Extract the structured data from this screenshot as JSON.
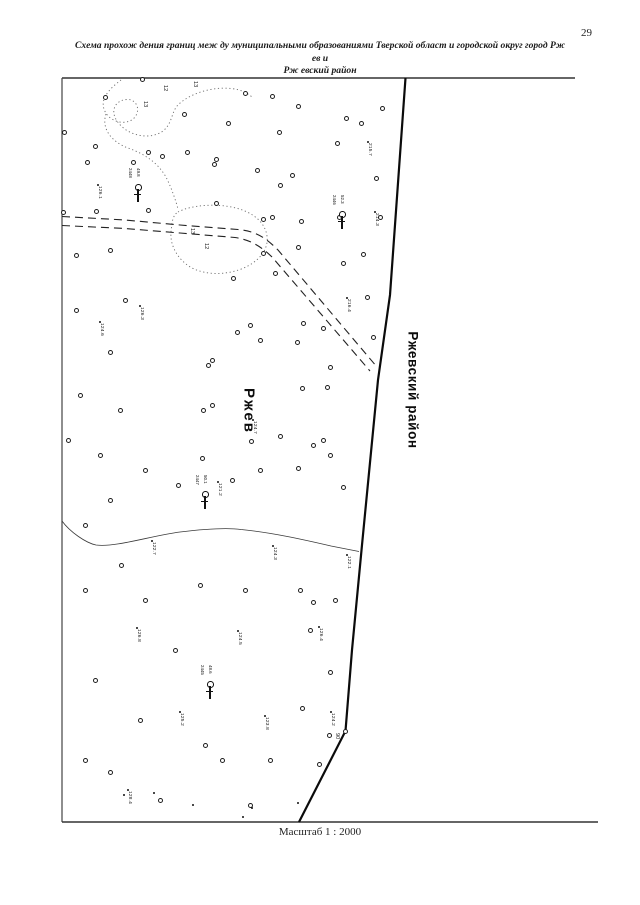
{
  "page": {
    "number": "29",
    "title_line1": "Схема прохож дения границ меж ду муниципальными образованиями Тверской област и городской округ город Рж ев и",
    "title_line2": "Рж евский район",
    "scale_label": "Масштаб 1 : 2000"
  },
  "map": {
    "labels": {
      "city": "Ржев",
      "district": "Ржевский район"
    },
    "colors": {
      "ink": "#111111",
      "contour_gray": "#6a6a6a",
      "frame": "#333333"
    },
    "paths": {
      "frame_top": "M62,78 H575",
      "frame_left": "M62,78 V822",
      "frame_bottom": "M62,822 H598",
      "boundary": "M405.5,78 L390,295 L378,380 L362,545 L352,650 L345.5,731 L299,822",
      "road_upper": "M62,216.5 L125,220 L180,225 L238,229.5 C256,231 266,238 278,250 L377,367",
      "road_lower": "M62,225.5 L125,228.5 L180,233 L235,237.5 C251,240 261,246.5 272,257 L370,371",
      "stream": "M62,521 C70,532 86,543 96,545 C116,547.5 150,536 180,532 C205,529 226,527.5 241,529.5 C271,532.5 301,539 331,546 L359,551.5",
      "meander": "M121,80 C112,87 100,97 104,109 C108,122 127,127 135,117 C141,109 136,99 127,99.5 C115,100 110,111 117,121 C128,137 151,140 163,131 C173,123 171,111 179,104 C191,93 213,86.5 231,88.5 C241,89.5 248,93 253,98",
      "meander_tail": "M106,114 C101,129 112,142 128,148 C145,154 158,163 166,177 C171,187 175,198 178,209",
      "blob": "M178,212 C191,205 216,203 236,208 C253,212.5 265,222 267,236 C269,250 258,263 240,269.5 C220,276.5 198,274 186,264 C176,256 170,244 171,232 C172,221 173,215 178,212 Z"
    },
    "markers": [
      {
        "t": "c",
        "x": 105,
        "y": 97
      },
      {
        "t": "c",
        "x": 142,
        "y": 79
      },
      {
        "t": "c",
        "x": 184,
        "y": 114
      },
      {
        "t": "c",
        "x": 228,
        "y": 123
      },
      {
        "t": "c",
        "x": 245,
        "y": 93
      },
      {
        "t": "c",
        "x": 272,
        "y": 96
      },
      {
        "t": "c",
        "x": 298,
        "y": 106
      },
      {
        "t": "c",
        "x": 337,
        "y": 143
      },
      {
        "t": "c",
        "x": 279,
        "y": 132
      },
      {
        "t": "c",
        "x": 292,
        "y": 175
      },
      {
        "t": "c",
        "x": 257,
        "y": 170
      },
      {
        "t": "c",
        "x": 216,
        "y": 159
      },
      {
        "t": "c",
        "x": 162,
        "y": 156
      },
      {
        "t": "c",
        "x": 133,
        "y": 162
      },
      {
        "t": "c",
        "x": 87,
        "y": 162
      },
      {
        "t": "c",
        "x": 64,
        "y": 132
      },
      {
        "t": "c",
        "x": 95,
        "y": 146
      },
      {
        "t": "c",
        "x": 148,
        "y": 152
      },
      {
        "t": "c",
        "x": 187,
        "y": 152
      },
      {
        "t": "c",
        "x": 214,
        "y": 164
      },
      {
        "t": "c",
        "x": 280,
        "y": 185
      },
      {
        "t": "c",
        "x": 216,
        "y": 203
      },
      {
        "t": "c",
        "x": 148,
        "y": 210
      },
      {
        "t": "c",
        "x": 96,
        "y": 211
      },
      {
        "t": "c",
        "x": 63,
        "y": 212
      },
      {
        "t": "c",
        "x": 263,
        "y": 219
      },
      {
        "t": "c",
        "x": 301,
        "y": 221
      },
      {
        "t": "c",
        "x": 339,
        "y": 217
      },
      {
        "t": "c",
        "x": 346,
        "y": 118
      },
      {
        "t": "c",
        "x": 361,
        "y": 123
      },
      {
        "t": "c",
        "x": 382,
        "y": 108
      },
      {
        "t": "c",
        "x": 376,
        "y": 178
      },
      {
        "t": "c",
        "x": 380,
        "y": 217
      },
      {
        "t": "c",
        "x": 363,
        "y": 254
      },
      {
        "t": "c",
        "x": 343,
        "y": 263
      },
      {
        "t": "c",
        "x": 367,
        "y": 297
      },
      {
        "t": "c",
        "x": 272,
        "y": 217
      },
      {
        "t": "c",
        "x": 298,
        "y": 247
      },
      {
        "t": "c",
        "x": 263,
        "y": 253
      },
      {
        "t": "c",
        "x": 275,
        "y": 273
      },
      {
        "t": "c",
        "x": 233,
        "y": 278
      },
      {
        "t": "c",
        "x": 250,
        "y": 325
      },
      {
        "t": "c",
        "x": 303,
        "y": 323
      },
      {
        "t": "c",
        "x": 323,
        "y": 328
      },
      {
        "t": "c",
        "x": 237,
        "y": 332
      },
      {
        "t": "c",
        "x": 260,
        "y": 340
      },
      {
        "t": "c",
        "x": 297,
        "y": 342
      },
      {
        "t": "c",
        "x": 330,
        "y": 367
      },
      {
        "t": "c",
        "x": 302,
        "y": 388
      },
      {
        "t": "c",
        "x": 327,
        "y": 387
      },
      {
        "t": "c",
        "x": 212,
        "y": 360
      },
      {
        "t": "c",
        "x": 208,
        "y": 365
      },
      {
        "t": "c",
        "x": 203,
        "y": 410
      },
      {
        "t": "c",
        "x": 212,
        "y": 405
      },
      {
        "t": "c",
        "x": 202,
        "y": 458
      },
      {
        "t": "c",
        "x": 232,
        "y": 480
      },
      {
        "t": "c",
        "x": 260,
        "y": 470
      },
      {
        "t": "c",
        "x": 298,
        "y": 468
      },
      {
        "t": "c",
        "x": 280,
        "y": 436
      },
      {
        "t": "c",
        "x": 313,
        "y": 445
      },
      {
        "t": "c",
        "x": 323,
        "y": 440
      },
      {
        "t": "c",
        "x": 330,
        "y": 455
      },
      {
        "t": "c",
        "x": 343,
        "y": 487
      },
      {
        "t": "c",
        "x": 110,
        "y": 250
      },
      {
        "t": "c",
        "x": 76,
        "y": 255
      },
      {
        "t": "c",
        "x": 125,
        "y": 300
      },
      {
        "t": "c",
        "x": 76,
        "y": 310
      },
      {
        "t": "c",
        "x": 110,
        "y": 352
      },
      {
        "t": "c",
        "x": 80,
        "y": 395
      },
      {
        "t": "c",
        "x": 120,
        "y": 410
      },
      {
        "t": "c",
        "x": 68,
        "y": 440
      },
      {
        "t": "c",
        "x": 100,
        "y": 455
      },
      {
        "t": "c",
        "x": 145,
        "y": 470
      },
      {
        "t": "c",
        "x": 178,
        "y": 485
      },
      {
        "t": "c",
        "x": 110,
        "y": 500
      },
      {
        "t": "c",
        "x": 85,
        "y": 525
      },
      {
        "t": "c",
        "x": 121,
        "y": 565
      },
      {
        "t": "c",
        "x": 85,
        "y": 590
      },
      {
        "t": "c",
        "x": 145,
        "y": 600
      },
      {
        "t": "c",
        "x": 200,
        "y": 585
      },
      {
        "t": "c",
        "x": 245,
        "y": 590
      },
      {
        "t": "c",
        "x": 300,
        "y": 590
      },
      {
        "t": "c",
        "x": 335,
        "y": 600
      },
      {
        "t": "c",
        "x": 310,
        "y": 630
      },
      {
        "t": "c",
        "x": 175,
        "y": 650
      },
      {
        "t": "c",
        "x": 95,
        "y": 680
      },
      {
        "t": "c",
        "x": 140,
        "y": 720
      },
      {
        "t": "c",
        "x": 205,
        "y": 745
      },
      {
        "t": "c",
        "x": 85,
        "y": 760
      },
      {
        "t": "c",
        "x": 110,
        "y": 772
      },
      {
        "t": "c",
        "x": 160,
        "y": 800
      },
      {
        "t": "c",
        "x": 250,
        "y": 805
      },
      {
        "t": "c",
        "x": 222,
        "y": 760
      },
      {
        "t": "c",
        "x": 270,
        "y": 760
      },
      {
        "t": "c",
        "x": 330,
        "y": 672
      },
      {
        "t": "c",
        "x": 302,
        "y": 708
      },
      {
        "t": "c",
        "x": 329,
        "y": 735
      },
      {
        "t": "c",
        "x": 319,
        "y": 764
      },
      {
        "t": "c",
        "x": 313,
        "y": 602
      },
      {
        "t": "c",
        "x": 373,
        "y": 337
      },
      {
        "t": "c",
        "x": 345,
        "y": 731
      },
      {
        "t": "c",
        "x": 251,
        "y": 441
      },
      {
        "t": "d",
        "x": 154,
        "y": 793
      },
      {
        "t": "d",
        "x": 193,
        "y": 805
      },
      {
        "t": "d",
        "x": 252,
        "y": 808
      },
      {
        "t": "d",
        "x": 124,
        "y": 795
      },
      {
        "t": "d",
        "x": 298,
        "y": 803
      },
      {
        "t": "d",
        "x": 243,
        "y": 817
      },
      {
        "t": "e",
        "x": 98,
        "y": 185,
        "l": "126.1"
      },
      {
        "t": "e",
        "x": 100,
        "y": 322,
        "l": "124.6"
      },
      {
        "t": "e",
        "x": 140,
        "y": 306,
        "l": "126.3"
      },
      {
        "t": "e",
        "x": 347,
        "y": 298,
        "l": "216.4"
      },
      {
        "t": "e",
        "x": 253,
        "y": 420,
        "l": "124.7"
      },
      {
        "t": "e",
        "x": 218,
        "y": 482,
        "l": "121.2"
      },
      {
        "t": "e",
        "x": 273,
        "y": 546,
        "l": "124.3"
      },
      {
        "t": "e",
        "x": 347,
        "y": 555,
        "l": "122.1"
      },
      {
        "t": "e",
        "x": 152,
        "y": 541,
        "l": "122.7"
      },
      {
        "t": "e",
        "x": 137,
        "y": 628,
        "l": "126.8"
      },
      {
        "t": "e",
        "x": 238,
        "y": 631,
        "l": "124.5"
      },
      {
        "t": "e",
        "x": 319,
        "y": 627,
        "l": "126.4"
      },
      {
        "t": "e",
        "x": 180,
        "y": 712,
        "l": "125.2"
      },
      {
        "t": "e",
        "x": 265,
        "y": 716,
        "l": "123.8"
      },
      {
        "t": "e",
        "x": 331,
        "y": 712,
        "l": "124.2"
      },
      {
        "t": "e",
        "x": 128,
        "y": 790,
        "l": "128.4"
      },
      {
        "t": "e",
        "x": 375,
        "y": 212,
        "l": "214.3"
      },
      {
        "t": "e",
        "x": 368,
        "y": 142,
        "l": "215.7"
      },
      {
        "t": "n",
        "x": 148,
        "y": 101,
        "l": "13"
      },
      {
        "t": "n",
        "x": 168,
        "y": 85,
        "l": "12"
      },
      {
        "t": "n",
        "x": 198,
        "y": 81,
        "l": "13"
      },
      {
        "t": "n",
        "x": 195,
        "y": 228,
        "l": "13"
      },
      {
        "t": "n",
        "x": 209,
        "y": 243,
        "l": "12"
      },
      {
        "t": "n",
        "x": 340,
        "y": 733,
        "l": "90"
      },
      {
        "t": "b",
        "x": 138,
        "y": 183,
        "l": "2448",
        "l2": "49.8"
      },
      {
        "t": "b",
        "x": 342,
        "y": 210,
        "l": "2446",
        "l2": "52.3"
      },
      {
        "t": "b",
        "x": 205,
        "y": 490,
        "l": "2447",
        "l2": "50.1"
      },
      {
        "t": "b",
        "x": 210,
        "y": 680,
        "l": "2445",
        "l2": "48.6"
      }
    ]
  }
}
